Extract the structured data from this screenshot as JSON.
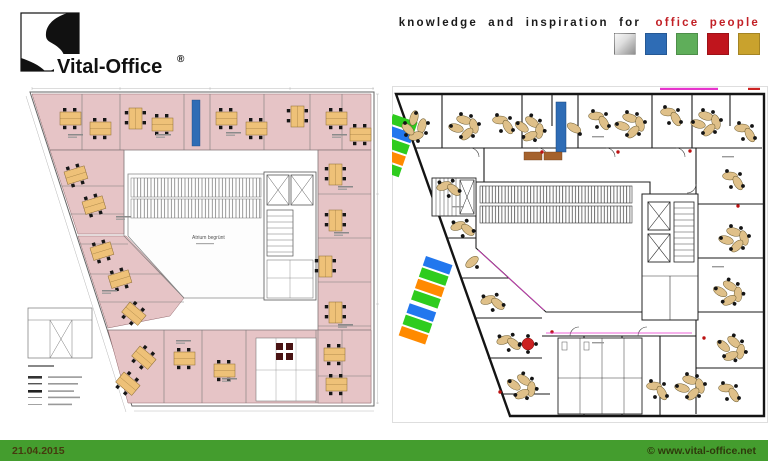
{
  "window": {
    "width": 768,
    "height": 461,
    "background": "#ffffff"
  },
  "header": {
    "logo": {
      "brand_text": "Vital-Office",
      "registered_mark": "®"
    },
    "tagline": {
      "text_black": "knowledge and inspiration for",
      "text_red": "office people",
      "red_color": "#c22026"
    },
    "color_swatches": [
      {
        "name": "silver",
        "color": "#b9b9b9"
      },
      {
        "name": "blue",
        "color": "#2e6cb5"
      },
      {
        "name": "green",
        "color": "#5fae5a"
      },
      {
        "name": "red",
        "color": "#c0151d"
      },
      {
        "name": "gold",
        "color": "#c9a22d"
      }
    ]
  },
  "plans": {
    "left": {
      "atrium_label": "Atrium begrünt",
      "room_highlight_color": "#e6c4c6",
      "desk_color": "#eec178"
    },
    "right": {
      "desk_color": "#dfc089",
      "wall_color": "#141414",
      "accent_blue": "#2e6cb5",
      "accent_green": "#2ecc1e",
      "accent_orange": "#ff8a00",
      "accent_magenta": "#e633cc",
      "accent_red": "#bb1111"
    }
  },
  "footer": {
    "bar_color": "#449d2e",
    "date": "21.04.2015",
    "website": "© www.vital-office.net"
  }
}
